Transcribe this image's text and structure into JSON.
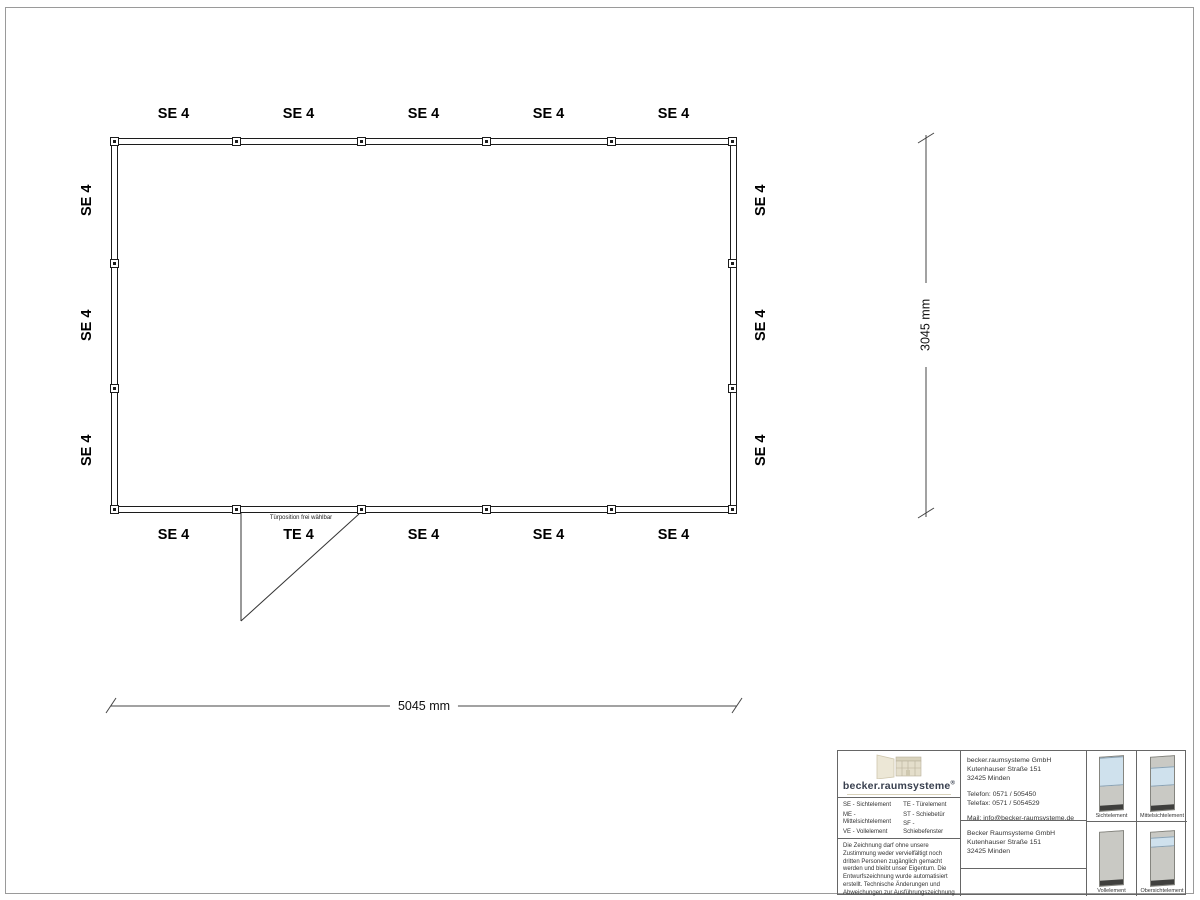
{
  "drawing": {
    "top_labels": [
      "SE 4",
      "SE 4",
      "SE 4",
      "SE 4",
      "SE 4"
    ],
    "bottom_labels": [
      "SE 4",
      "TE 4",
      "SE 4",
      "SE 4",
      "SE 4"
    ],
    "left_labels": [
      "SE 4",
      "SE 4",
      "SE 4"
    ],
    "right_labels": [
      "SE 4",
      "SE 4",
      "SE 4"
    ],
    "door_note": "Türposition frei wählbar",
    "width_dimension": "5045 mm",
    "height_dimension": "3045 mm"
  },
  "title_block": {
    "logo_text": "becker.raumsysteme",
    "logo_registered": "®",
    "legend": {
      "col1": [
        "SE - Sichtelement",
        "ME - Mittelsichtelement",
        "VE - Vollelement",
        "OE - Obersichtelement"
      ],
      "col2": [
        "TE - Türelement",
        "ST - Schiebetür",
        "SF - Schiebefenster",
        "DKF - Drehkippfenster"
      ]
    },
    "disclaimer": "Die Zeichnung darf ohne unsere Zustimmung weder vervielfältigt noch dritten Personen zugänglich gemacht werden und bleibt unser Eigentum. Die Entwurfszeichnung wurde automatisiert erstellt. Technische Änderungen und Abweichungen zur Ausführungszeichnung behalten wir uns vor.",
    "contact": {
      "company": "becker.raumsysteme GmbH",
      "street": "Kutenhauser Straße 151",
      "city": "32425 Minden",
      "phone": "Telefon: 0571 / 505450",
      "fax": "Telefax: 0571 / 5054529",
      "mail": "Mail: info@becker-raumsysteme.de",
      "web": "Web: www.becker-raumsysteme.de"
    },
    "manufacturer": {
      "company": "Becker Raumsysteme GmbH",
      "street": "Kutenhauser Straße 151",
      "city": "32425 Minden"
    },
    "elements": [
      {
        "label": "Sichtelement"
      },
      {
        "label": "Mittelsichtelement"
      },
      {
        "label": "Vollelement"
      },
      {
        "label": "Obersichtelement"
      }
    ]
  },
  "colors": {
    "line": "#1c1c1c",
    "titleblock_border": "#666666",
    "logo_navy": "#39404f",
    "logo_beige": "#e8e3d2",
    "panel_gray": "#c9c9c4",
    "panel_glass": "#cfe1ed",
    "panel_base": "#3f3f3d"
  }
}
